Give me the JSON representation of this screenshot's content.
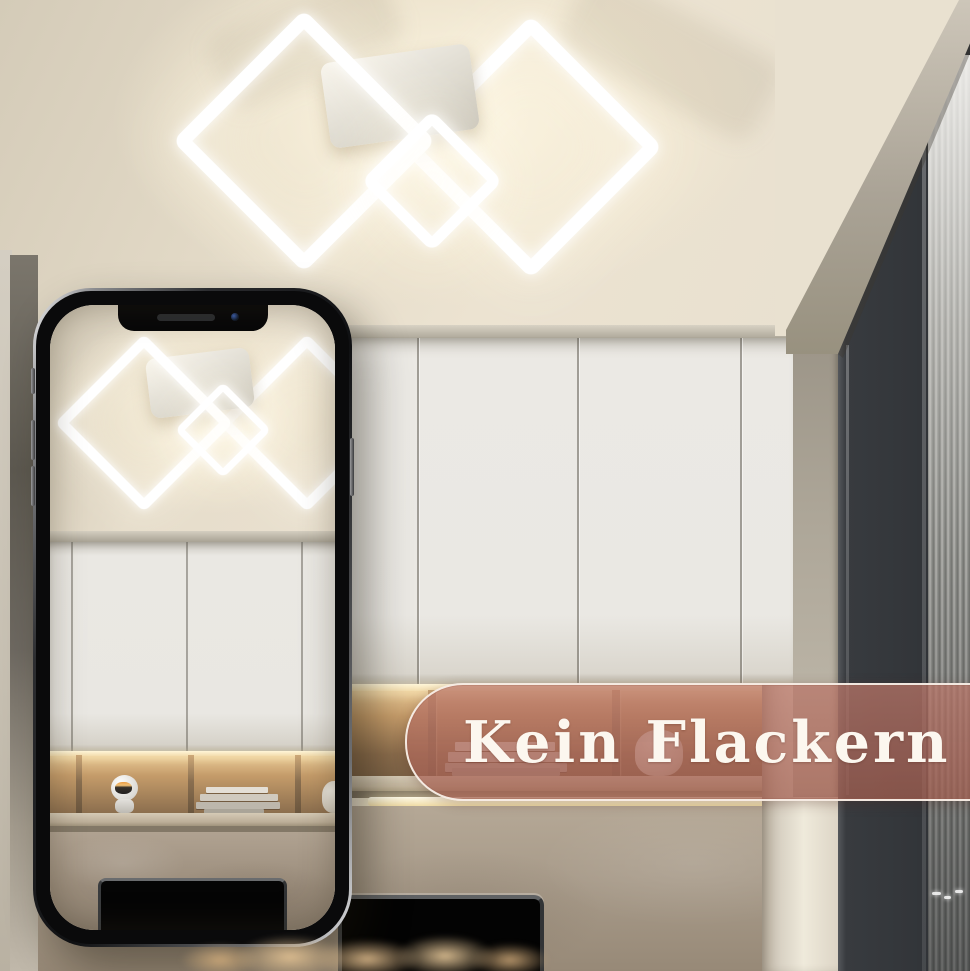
{
  "banner": {
    "text": "Kein Flackern",
    "fill_color": "#B26758",
    "fill_opacity": "0.72",
    "border_color": "#FAF3EB",
    "text_color": "#FCF7EF"
  },
  "phone": {
    "device": "smartphone-mockup",
    "notch_speaker": "speaker-grille",
    "notch_camera": "front-camera-dot",
    "screen_shows": "ceiling light scene"
  },
  "scene": {
    "ceiling_light_frames": 3,
    "elements": [
      "led-ceiling-light",
      "ceiling",
      "white-cabinets",
      "open-shelf",
      "book-stack",
      "astronaut-figurine",
      "under-shelf-light",
      "stone-wall",
      "tv-screen",
      "stone-column",
      "window-frame",
      "fluted-glass",
      "pampas-grass"
    ]
  },
  "colors": {
    "ceiling": "#E6DECC",
    "light_glow": "#FFF8E6",
    "cabinets": "#EAE8E3",
    "shelf_wood": "#AA8659",
    "stone_wall": "#A89B8A",
    "window_frame": "#3A3D41",
    "banner_accent": "#B26758"
  }
}
